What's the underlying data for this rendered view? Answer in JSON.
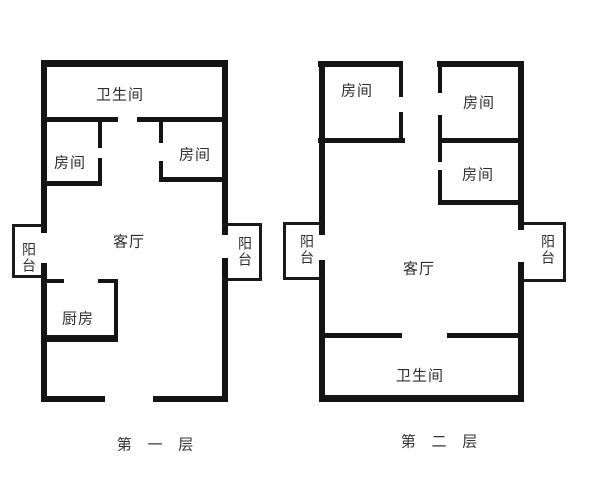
{
  "title": "两层户型图",
  "colors": {
    "wall": "#141414",
    "text": "#2e2e2e",
    "background": "#fefefe"
  },
  "floor1": {
    "caption": "第 一 层",
    "labels": {
      "bathroom": "卫生间",
      "bedroom_left": "房间",
      "bedroom_right": "房间",
      "living_room": "客厅",
      "kitchen": "厨房",
      "balcony_left": "阳台",
      "balcony_right": "阳台"
    }
  },
  "floor2": {
    "caption": "第 二 层",
    "labels": {
      "bedroom_top_left": "房间",
      "bedroom_top_right": "房间",
      "bedroom_mid_right": "房间",
      "living_room": "客厅",
      "bathroom": "卫生间",
      "balcony_left": "阳台",
      "balcony_right": "阳台"
    }
  }
}
